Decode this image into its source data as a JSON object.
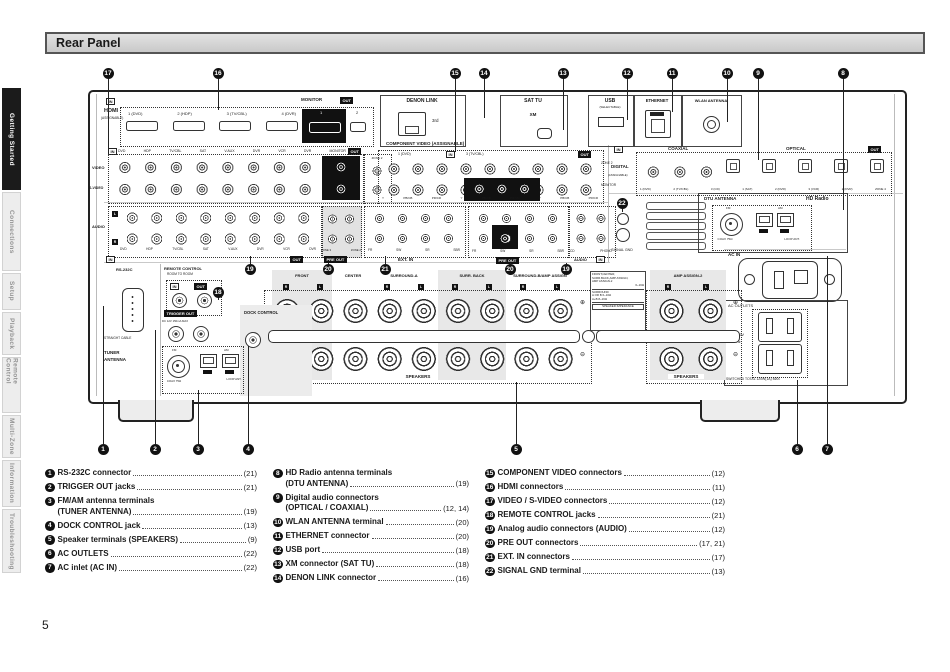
{
  "page_number": "5",
  "header": {
    "title": "Rear Panel"
  },
  "sidebar": {
    "tabs": [
      {
        "label": "Getting Started",
        "active": true
      },
      {
        "label": "Connections",
        "active": false
      },
      {
        "label": "Setup",
        "active": false
      },
      {
        "label": "Playback",
        "active": false
      },
      {
        "label": "Remote Control",
        "active": false
      },
      {
        "label": "Multi-Zone",
        "active": false
      },
      {
        "label": "Information",
        "active": false
      },
      {
        "label": "Troubleshooting",
        "active": false
      }
    ]
  },
  "diagram": {
    "labels": {
      "in": "IN",
      "out": "OUT",
      "hdmi": "HDMI",
      "assignable": "(ASSIGNABLE)",
      "hdmi_ports": [
        "1 (DVD)",
        "2 (HDP)",
        "3 (TV/CBL)",
        "4 (DVR)"
      ],
      "monitor": "MONITOR",
      "monitor_1": "1",
      "monitor_2": "2",
      "denon_link": "DENON LINK",
      "third": "3rd",
      "sat_tu": "SAT TU",
      "xm": "XM",
      "usb": "USB",
      "selectable": "(SELECTABLE)",
      "ethernet": "ETHERNET",
      "wlan": "WLAN ANTENNA",
      "video": "VIDEO",
      "s_video": "S-VIDEO",
      "video_cols": [
        "DVD",
        "HDP",
        "TV/CBL",
        "SAT",
        "V.AUX",
        "DVR",
        "VCR",
        "DVR",
        "MONITOR"
      ],
      "zone2": "ZONE 2",
      "component_title": "COMPONENT VIDEO (ASSIGNABLE)",
      "comp_l1": "1 (DVD)",
      "comp_l2": "3 (TV/CBL)",
      "comp_axis": [
        "Y",
        "PB/CB",
        "PR/CR",
        "Y",
        "PB/CB",
        "PR/CR",
        "Y",
        "PB/CB",
        "PR/CR"
      ],
      "comp_zone2": "ZONE 2",
      "comp_monitor": "MONITOR",
      "digital": "DIGITAL",
      "coaxial": "COAXIAL",
      "optical": "OPTICAL",
      "digital_ports": [
        "1 (DVD)",
        "2 (TV/CBL)",
        "3 (CD)",
        "1 (SAT)",
        "2 (DVR)",
        "3 (VCR)",
        "2 (DVR)",
        "ZONE 4"
      ],
      "audio": "AUDIO",
      "l": "L",
      "r": "R",
      "audio_cols": [
        "DVD",
        "HDP",
        "TV/CBL",
        "SAT",
        "V.AUX",
        "DVR",
        "VCR",
        "DVR"
      ],
      "zone_cols": [
        "ZONE 3",
        "ZONE 2"
      ],
      "pre_out": "PRE OUT",
      "ext_in": "EXT. IN",
      "extin_cols": [
        "FR",
        "SW",
        "SR",
        "SBR"
      ],
      "preout_cols": [
        "FR",
        "SW",
        "SR",
        "SBR"
      ],
      "phono_cols": [
        "CD",
        "PHONO"
      ],
      "signal_gnd": "SIGNAL GND",
      "dtu": "DTU ANTENNA",
      "hd_radio": "HD Radio",
      "fm": "FM",
      "am": "AM",
      "coax75": "COAX 75Ω",
      "loop_ant": "LOOP ANT.",
      "ac_in": "AC IN",
      "ac_outlets": "AC OUTLETS",
      "ac_120v": "AC 120V",
      "hz60": "60Hz",
      "switched": "SWITCHED TOTAL 120W(1A) MAX",
      "rs232c": "RS-232C",
      "straight_cable": "STRAIGHT CABLE",
      "tuner": "TUNER",
      "antenna": "ANTENNA",
      "remote_control": "REMOTE CONTROL",
      "room_to_room": "ROOM TO ROOM",
      "trigger_out": "TRIGGER OUT",
      "trigger_spec": "DC 12V 150mA MAX",
      "dock_control": "DOCK CONTROL",
      "front": "FRONT",
      "center": "CENTER",
      "surround_a": "SURROUND-A",
      "surr_back": "SURR. BACK",
      "surround_b": "SURROUND-B/AMP ASSIGN",
      "amp_assign2": "AMP ASSIGN-2",
      "speakers": "SPEAKERS",
      "imp1": "FRONT,CENTER,",
      "imp2": "SURR.BACK,AMP ASSIGN,",
      "imp3": "AMP ASSIGN-2",
      "imp4": "6~16Ω",
      "imp5": "SURROUND",
      "imp6": "A OR B  6~16Ω",
      "imp7": "A+B  8~16Ω",
      "imp8": "SPEAKER IMPEDANCE",
      "plus": "⊕",
      "minus": "⊖"
    },
    "callouts": [
      {
        "n": "17",
        "x": 108,
        "y": 73,
        "ly": 148
      },
      {
        "n": "16",
        "x": 218,
        "y": 73,
        "ly": 110
      },
      {
        "n": "15",
        "x": 455,
        "y": 73,
        "ly": 152
      },
      {
        "n": "14",
        "x": 484,
        "y": 73,
        "ly": 118
      },
      {
        "n": "13",
        "x": 563,
        "y": 73,
        "ly": 130
      },
      {
        "n": "12",
        "x": 627,
        "y": 73,
        "ly": 120
      },
      {
        "n": "11",
        "x": 672,
        "y": 73,
        "ly": 112
      },
      {
        "n": "10",
        "x": 727,
        "y": 73,
        "ly": 122
      },
      {
        "n": "9",
        "x": 758,
        "y": 73,
        "ly": 160
      },
      {
        "n": "8",
        "x": 843,
        "y": 73,
        "ly": 210
      },
      {
        "n": "1",
        "x": 103,
        "y": 449,
        "ly": 306
      },
      {
        "n": "2",
        "x": 155,
        "y": 449,
        "ly": 330
      },
      {
        "n": "3",
        "x": 198,
        "y": 449,
        "ly": 390
      },
      {
        "n": "4",
        "x": 248,
        "y": 449,
        "ly": 346
      },
      {
        "n": "5",
        "x": 516,
        "y": 449,
        "ly": 382
      },
      {
        "n": "6",
        "x": 797,
        "y": 449,
        "ly": 380
      },
      {
        "n": "7",
        "x": 827,
        "y": 449,
        "ly": 256
      },
      {
        "n": "18",
        "x": 218,
        "y": 292,
        "ly": 300
      },
      {
        "n": "19",
        "x": 250,
        "y": 269,
        "ly": 256
      },
      {
        "n": "20",
        "x": 328,
        "y": 269,
        "ly": 263
      },
      {
        "n": "21",
        "x": 385,
        "y": 269,
        "ly": 256
      },
      {
        "n": "20",
        "x": 510,
        "y": 269,
        "ly": 263
      },
      {
        "n": "19",
        "x": 566,
        "y": 269,
        "ly": 263
      },
      {
        "n": "22",
        "x": 622,
        "y": 203,
        "ly": 212
      }
    ]
  },
  "legend": {
    "columns": [
      [
        {
          "num": "1",
          "label": "RS-232C connector",
          "page": "(21)"
        },
        {
          "num": "2",
          "label": "TRIGGER OUT jacks",
          "page": "(21)"
        },
        {
          "num": "3",
          "label": "FM/AM antenna terminals",
          "label2": "(TUNER ANTENNA)",
          "page": "(19)"
        },
        {
          "num": "4",
          "label": "DOCK CONTROL jack",
          "page": "(13)"
        },
        {
          "num": "5",
          "label": "Speaker terminals (SPEAKERS)",
          "page": "(9)"
        },
        {
          "num": "6",
          "label": "AC OUTLETS",
          "page": "(22)"
        },
        {
          "num": "7",
          "label": "AC inlet (AC IN)",
          "page": "(22)"
        }
      ],
      [
        {
          "num": "8",
          "label": "HD Radio antenna terminals",
          "label2": "(DTU ANTENNA)",
          "page": "(19)"
        },
        {
          "num": "9",
          "label": "Digital audio connectors",
          "label2": "(OPTICAL / COAXIAL)",
          "page": "(12, 14)"
        },
        {
          "num": "10",
          "label": "WLAN ANTENNA terminal",
          "page": "(20)"
        },
        {
          "num": "11",
          "label": "ETHERNET connector",
          "page": "(20)"
        },
        {
          "num": "12",
          "label": "USB port",
          "page": "(18)"
        },
        {
          "num": "13",
          "label": "XM connector (SAT TU)",
          "page": "(18)"
        },
        {
          "num": "14",
          "label": "DENON LINK connector",
          "page": "(16)"
        }
      ],
      [
        {
          "num": "15",
          "label": "COMPONENT VIDEO connectors",
          "page": "(12)"
        },
        {
          "num": "16",
          "label": "HDMI connectors",
          "page": "(11)"
        },
        {
          "num": "17",
          "label": "VIDEO / S-VIDEO connectors",
          "page": "(12)"
        },
        {
          "num": "18",
          "label": "REMOTE CONTROL jacks",
          "page": "(21)"
        },
        {
          "num": "19",
          "label": "Analog audio connectors (AUDIO)",
          "page": "(12)"
        },
        {
          "num": "20",
          "label": "PRE OUT connectors",
          "page": "(17, 21)"
        },
        {
          "num": "21",
          "label": "EXT. IN connectors",
          "page": "(17)"
        },
        {
          "num": "22",
          "label": "SIGNAL GND terminal",
          "page": "(13)"
        }
      ]
    ]
  }
}
